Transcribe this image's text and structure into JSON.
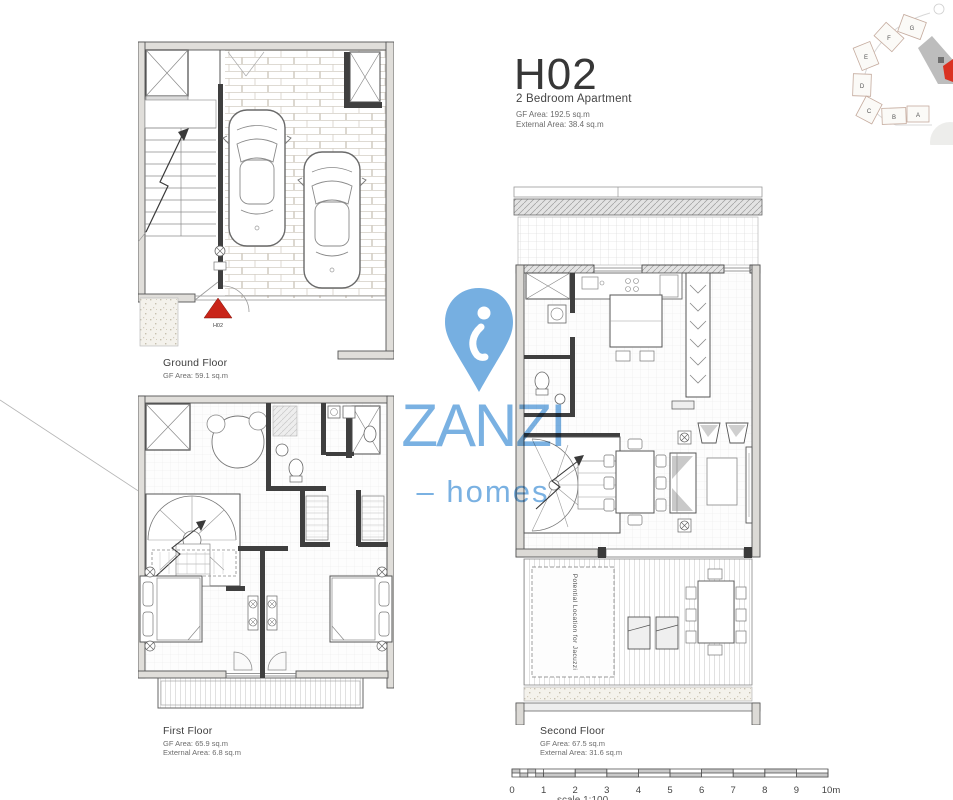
{
  "header": {
    "title": "H02",
    "subtitle": "2 Bedroom Apartment",
    "gf_area": "GF Area: 192.5 sq.m",
    "external_area": "External Area: 38.4 sq.m"
  },
  "floors": {
    "ground": {
      "name": "Ground Floor",
      "gf_area": "GF Area: 59.1 sq.m"
    },
    "first": {
      "name": "First Floor",
      "gf_area": "GF Area: 65.9 sq.m",
      "external_area": "External Area: 6.8 sq.m"
    },
    "second": {
      "name": "Second Floor",
      "gf_area": "GF Area: 67.5 sq.m",
      "external_area": "External Area: 31.6 sq.m",
      "jacuzzi_note": "Potential Location for Jacuzzi"
    }
  },
  "marker": {
    "label": "H02",
    "color": "#c9251a"
  },
  "watermark": {
    "brand": "ZANZI",
    "dash": "–",
    "word": "homes",
    "color": "#6fabe0"
  },
  "site_plan": {
    "units": [
      "G",
      "F",
      "E",
      "D",
      "C",
      "B",
      "A"
    ],
    "highlight_color": "#da3222"
  },
  "scale_bar": {
    "labels": [
      "0",
      "1",
      "2",
      "3",
      "4",
      "5",
      "6",
      "7",
      "8",
      "9",
      "10m"
    ],
    "note": "scale 1:100"
  }
}
